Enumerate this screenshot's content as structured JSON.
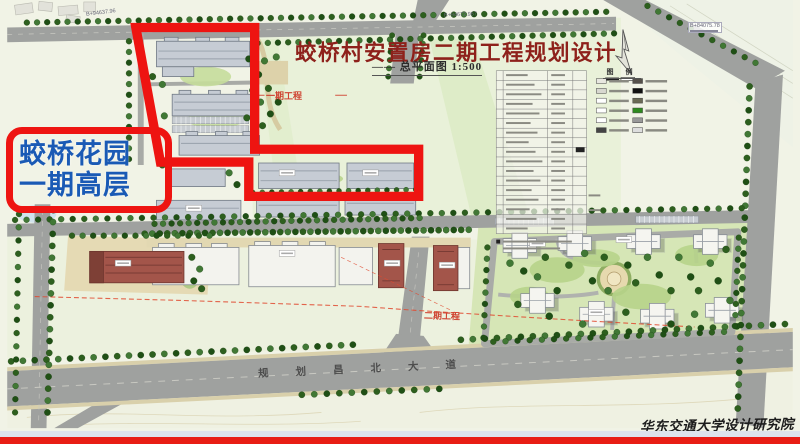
{
  "title": {
    "text": "蛟桥村安置房二期工程规划设计",
    "subtitle": "—— 总平面图 1:500",
    "color": "#8e211b"
  },
  "overlay": {
    "line1": "蛟桥花园",
    "line2": "一期高层",
    "text_color": "#1a5ab5",
    "border_color": "#ee1411"
  },
  "labels": {
    "phase1": "一期工程",
    "phase2": "二期工程",
    "road": "规划昌北大道",
    "legend_header": "图 例",
    "signature": "华东交通大学设计研究院"
  },
  "coords": {
    "top_left": "B+94637.96",
    "top_center": "B+94672.967",
    "top_right": "B+84075.78"
  },
  "colors": {
    "highlight_red": "#ee1411",
    "phase_label_red": "#cf4331",
    "dashed_boundary_red": "#e04a30",
    "bottom_bar_red": "#e81d15",
    "road_gray": "#9fa19f",
    "field_green": "#e9f1d9",
    "compound_green": "#d6e6b6"
  }
}
